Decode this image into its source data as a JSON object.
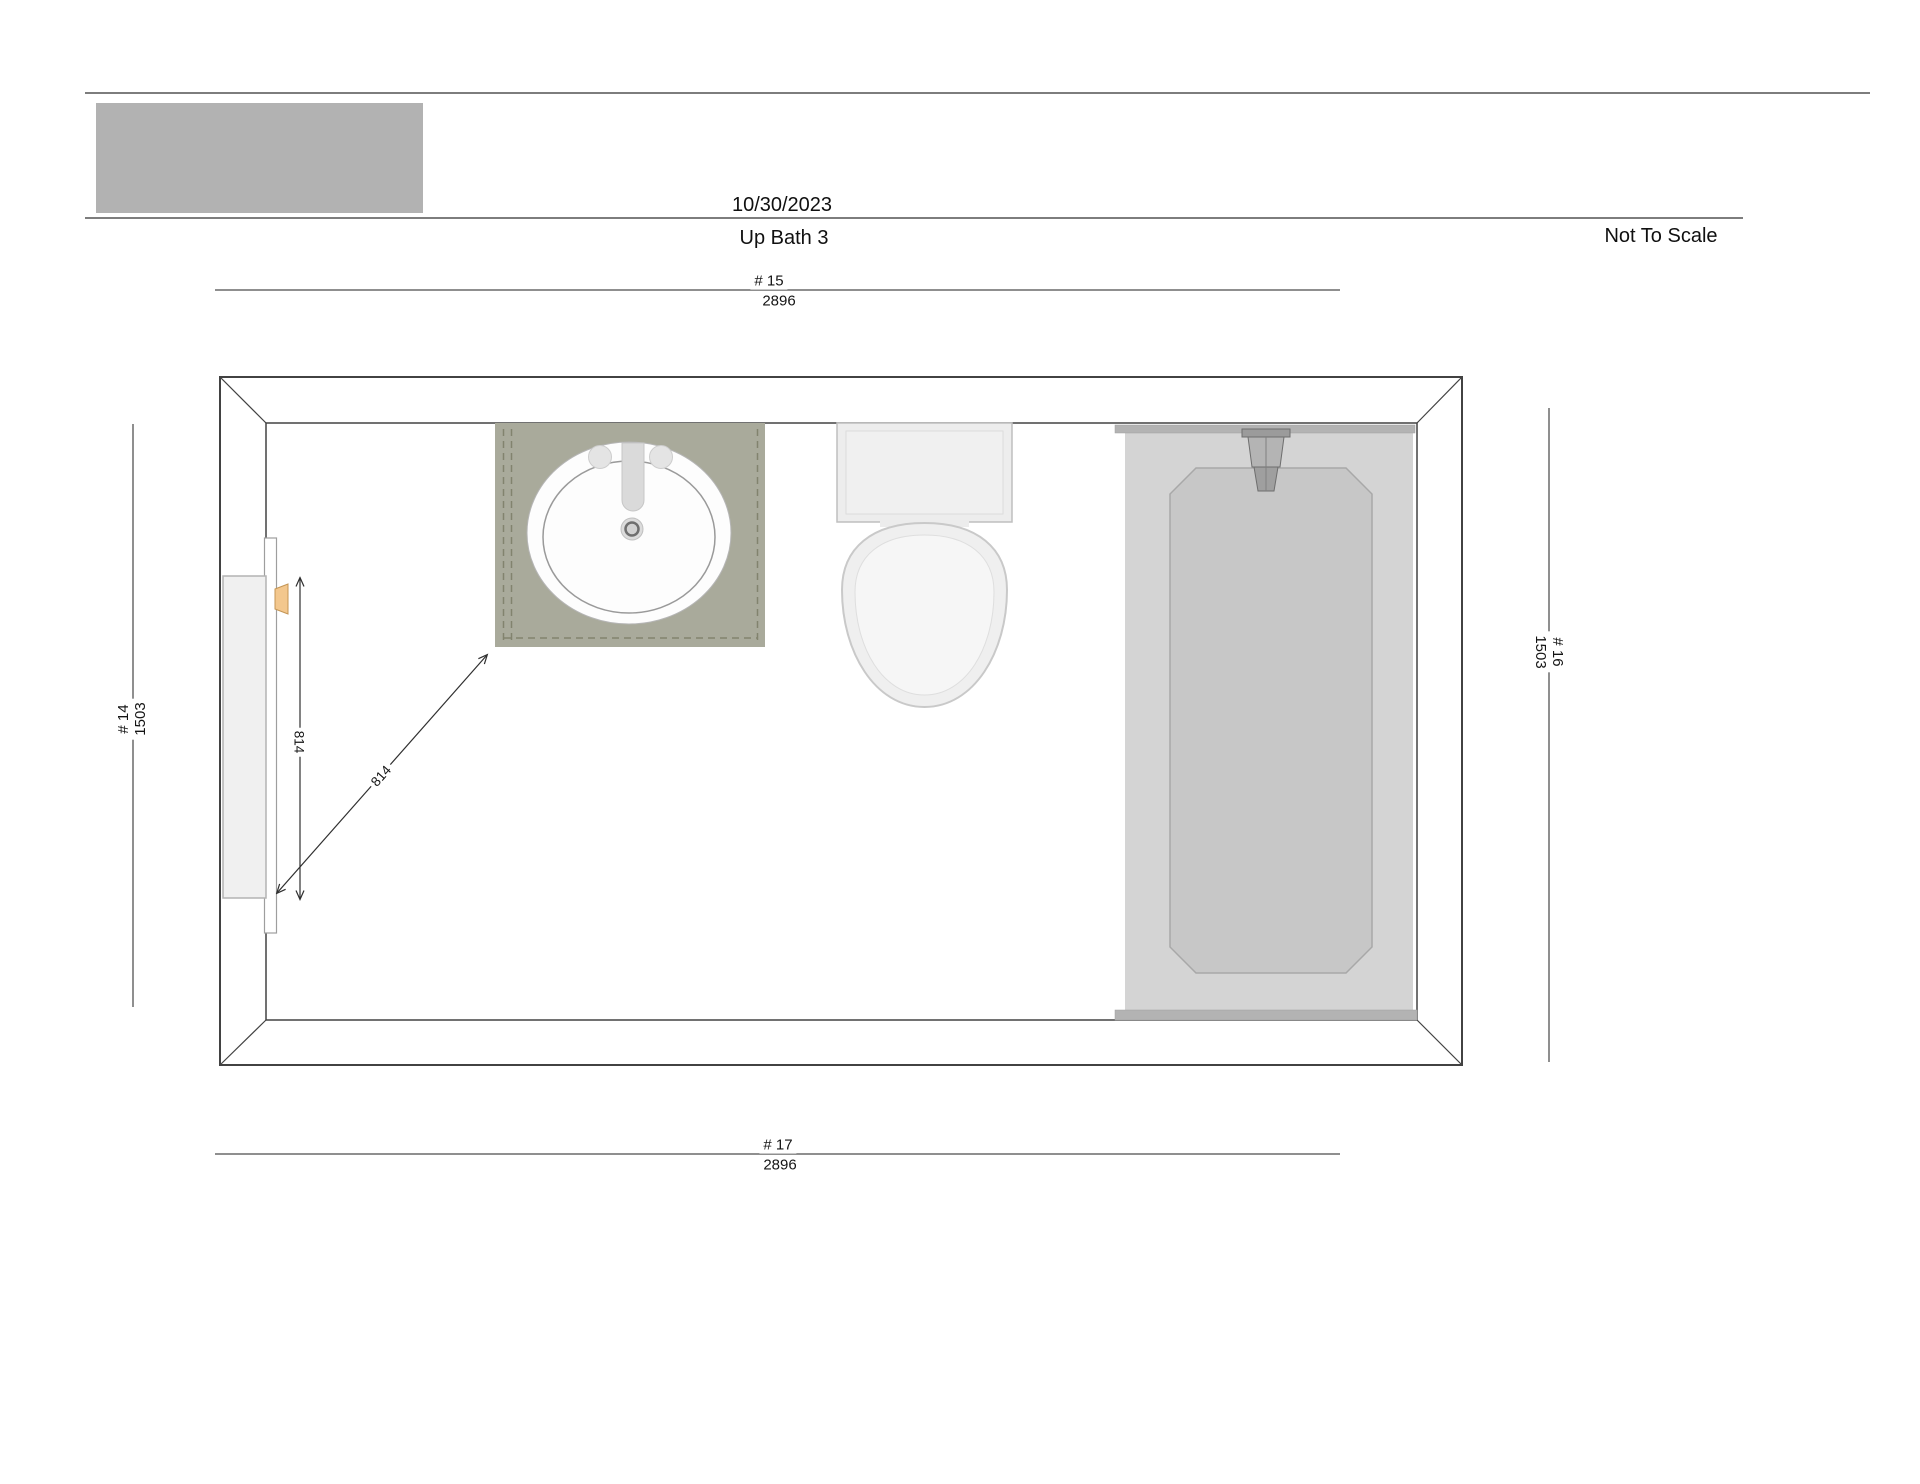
{
  "header": {
    "date": "10/30/2023",
    "title": "Up Bath 3",
    "scale_note": "Not To Scale"
  },
  "dimensions": {
    "top": {
      "label": "# 15",
      "value": "2896"
    },
    "bottom": {
      "label": "# 17",
      "value": "2896"
    },
    "left": {
      "label": "# 14",
      "value": "1503"
    },
    "right": {
      "label": "# 16",
      "value": "1503"
    },
    "door_width": {
      "value": "814"
    },
    "door_swing": {
      "value": "814"
    }
  },
  "colors": {
    "logo_placeholder": "#b2b2b2",
    "wall_line": "#424242",
    "dimension_line": "#8f8f8f",
    "vanity_top": "#a9aa9b",
    "vanity_dash": "#82836e",
    "tub_body": "#d4d4d4",
    "tub_basin": "#c7c7c7",
    "tub_rim": "#b3b3b3",
    "toilet": "#ededed",
    "door_handle": "#f3c78d"
  }
}
